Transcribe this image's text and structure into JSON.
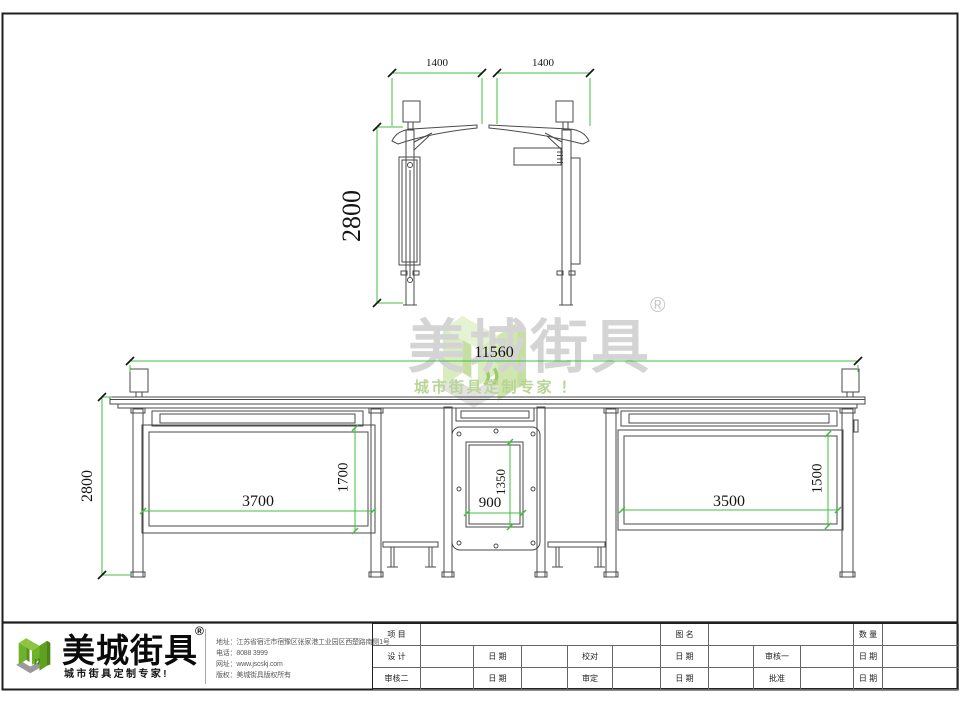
{
  "watermark": {
    "brand": "美城街具",
    "registered": "®",
    "slogan": "城市街具定制专家 ！"
  },
  "side_view": {
    "dim_width_left": "1400",
    "dim_width_right": "1400",
    "dim_height": "2800"
  },
  "elevation": {
    "dim_total_width": "11560",
    "dim_height": "2800",
    "dim_left_panel_width": "3700",
    "dim_left_panel_height": "1700",
    "dim_center_width": "900",
    "dim_center_height": "1350",
    "dim_right_panel_width": "3500",
    "dim_right_panel_height": "1500"
  },
  "footer": {
    "logo": {
      "brand": "美城街具",
      "registered": "®",
      "slogan": "城市街具定制专家!"
    },
    "company": {
      "address": "地址：江苏省宿迁市宿豫区张家港工业园区西楚路南侧1号",
      "phone": "电话：8088 3999",
      "website": "网址：www.jscskj.com",
      "copyright": "版权：美城街具版权所有"
    },
    "titleblock": {
      "r1": {
        "project": "项 目",
        "drawing_name": "图 名",
        "quantity": "数 量"
      },
      "r2": {
        "design": "设 计",
        "date1": "日 期",
        "proofread": "校对",
        "date2": "日 期",
        "review1": "审核一",
        "date3": "日 期"
      },
      "r3": {
        "review2": "审核二",
        "date1": "日 期",
        "approve": "审定",
        "date2": "日 期",
        "ratify": "批准",
        "date3": "日 期"
      }
    }
  },
  "colors": {
    "dimension_green": "#3fbf3f",
    "line_gray": "#4a4a4a",
    "logo_green": "#6eb32a",
    "watermark_green": "#d9ecc0",
    "watermark_gray": "#d4d4d4"
  }
}
